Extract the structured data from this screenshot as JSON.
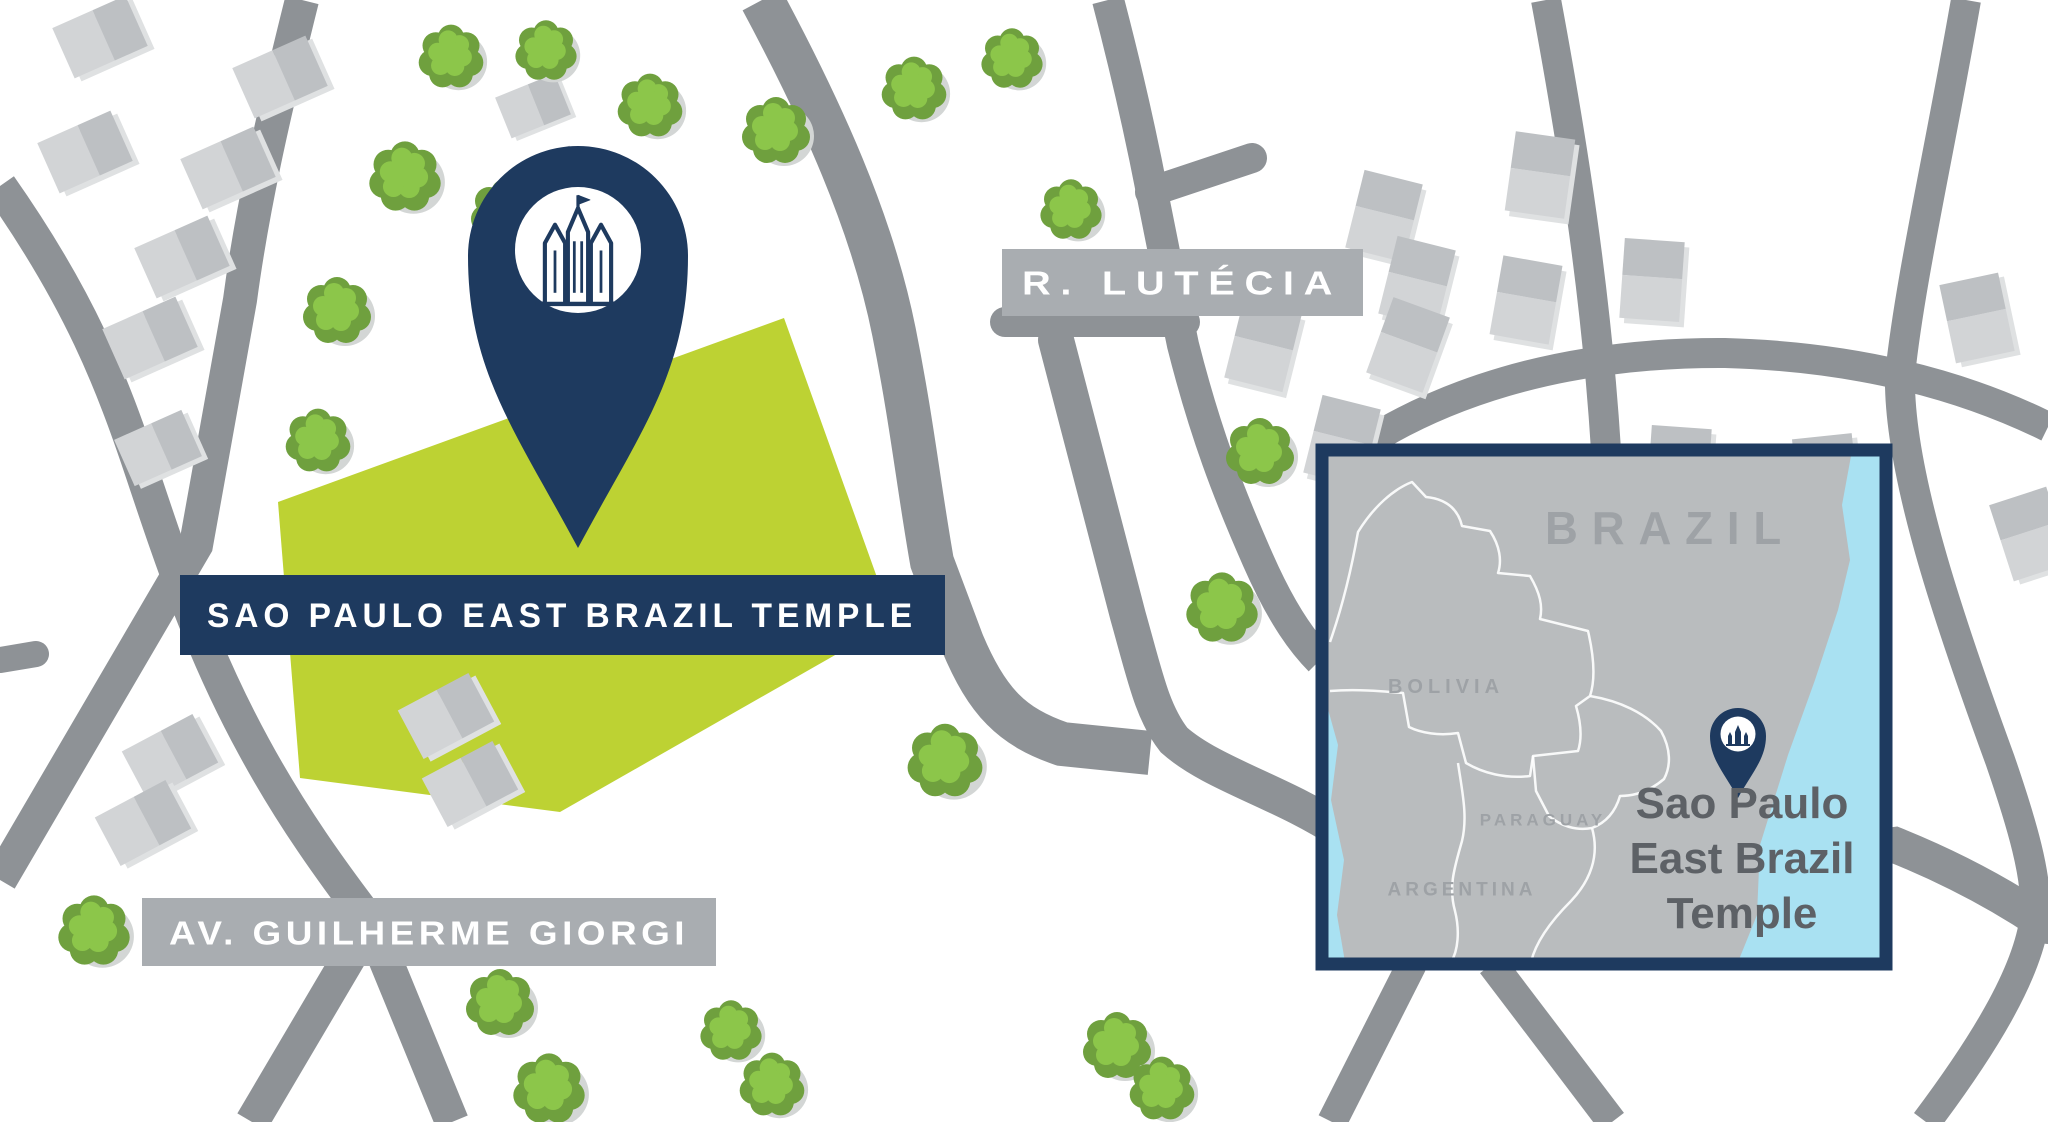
{
  "main_map": {
    "temple_label": "SAO PAULO EAST BRAZIL TEMPLE",
    "street_labels": [
      {
        "id": "lutecia",
        "text": "R. LUTÉCIA"
      },
      {
        "id": "guilherme",
        "text": "AV. GUILHERME GIORGI"
      }
    ]
  },
  "inset_map": {
    "title_label": "BRAZIL",
    "country_labels": [
      "BOLIVIA",
      "PARAGUAY",
      "ARGENTINA"
    ],
    "caption_lines": [
      "Sao Paulo",
      "East Brazil",
      "Temple"
    ]
  },
  "icons": {
    "main_pin": "temple-location-pin",
    "inset_pin": "temple-location-pin"
  },
  "colors": {
    "navy": "#1e3a5f",
    "road": "#8e9296",
    "label-bg": "#a9adb1",
    "lime": "#bdd233",
    "tree-dark": "#6fa03e",
    "tree-light": "#8cc64a",
    "tree-shadow": "#d3d6d5",
    "bldg-light": "#d2d4d6",
    "bldg-dark": "#bdc0c3",
    "bldg-shadow": "#dfe1e2",
    "land": "#b9bcbe",
    "ocean": "#a9e1f2",
    "inset-label": "#9ea2a6",
    "inset-text": "#5d6166"
  }
}
